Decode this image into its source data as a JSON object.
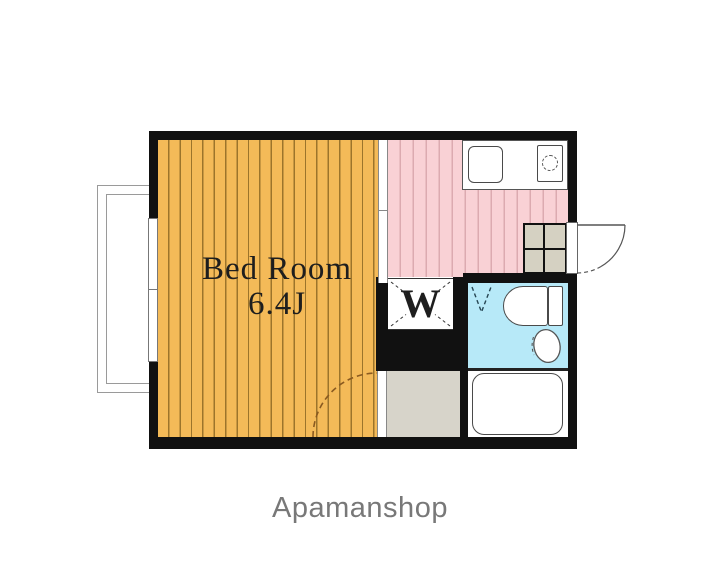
{
  "floorplan": {
    "bedroom": {
      "name": "Bed Room",
      "size": "6.4J"
    },
    "closet": {
      "label": "W"
    },
    "features": [
      "balcony-window",
      "sliding-partition",
      "kitchen-sink",
      "stove-burner",
      "shoe-cabinet",
      "entrance-door",
      "toilet",
      "wash-basin",
      "bathtub",
      "bedroom-door-swing",
      "bathroom-door-mark"
    ],
    "colors": {
      "bedroom_fill": "#F4BA58",
      "bedroom_stripe": "#9C742B",
      "kitchen_fill": "#F9D1D5",
      "kitchen_stripe": "#DCAAB0",
      "bathroom_fill": "#B7E9F8",
      "hallway_fill": "#D7D4CA",
      "cabinet_fill": "#D5D1C2",
      "wall": "#111111",
      "label_text": "#1E1E1E",
      "door_arc": "#8A5A20",
      "brand_text": "#787878"
    }
  },
  "footer": {
    "brand": "Apamanshop"
  }
}
